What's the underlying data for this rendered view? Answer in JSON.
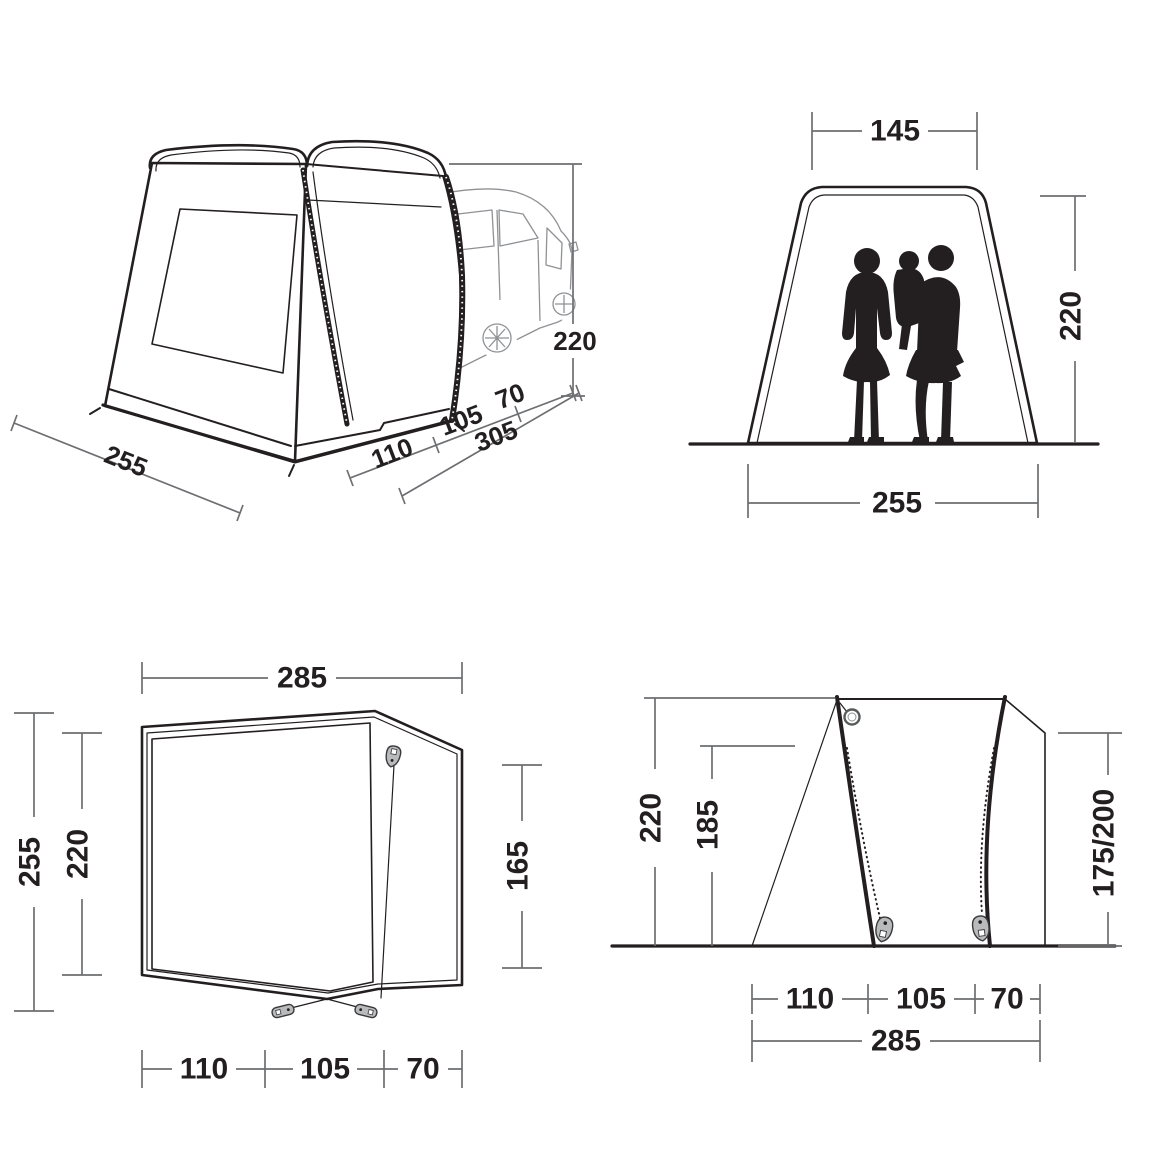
{
  "colors": {
    "ink": "#231f20",
    "dim_line": "#6d6e71",
    "text": "#231f20",
    "van_fill": "#d7d8d9",
    "van_line": "#8f9194",
    "mesh_fill": "#c9cacb",
    "floor_fill": "#c5c6c8",
    "hardware_fill": "#b9babc",
    "background": "#ffffff"
  },
  "views": {
    "perspective": {
      "labels": {
        "base_width": "255",
        "depth_front": "110",
        "depth_mid": "105",
        "depth_rear": "70",
        "depth_total": "305",
        "height": "220"
      }
    },
    "front": {
      "labels": {
        "top_width": "145",
        "height": "220",
        "base_width": "255"
      }
    },
    "plan": {
      "labels": {
        "width": "285",
        "depth_total": "255",
        "depth_inner": "220",
        "side_depth": "165",
        "seg_left": "110",
        "seg_mid": "105",
        "seg_right": "70"
      }
    },
    "side": {
      "labels": {
        "height": "220",
        "inner_height": "185",
        "attachment_height": "175/200",
        "seg_left": "110",
        "seg_mid": "105",
        "seg_right": "70",
        "width_total": "285"
      }
    }
  }
}
